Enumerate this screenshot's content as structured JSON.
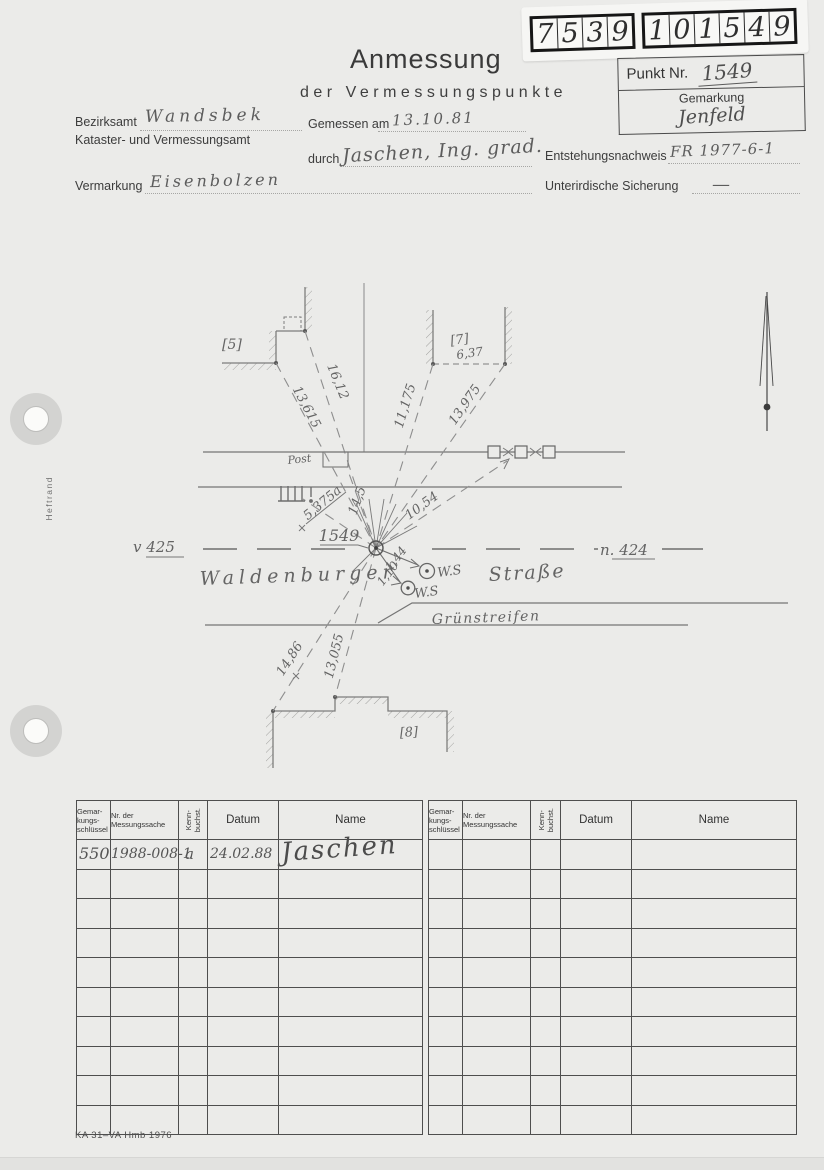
{
  "sticker": {
    "g1": [
      "7",
      "5",
      "3",
      "9"
    ],
    "g2": [
      "1",
      "0",
      "1",
      "5",
      "4",
      "9"
    ]
  },
  "punkt_box": {
    "punkt_label": "Punkt Nr.",
    "punkt_value": "1549",
    "gemarkung_label": "Gemarkung",
    "gemarkung_value": "Jenfeld"
  },
  "header": {
    "title": "Anmessung",
    "subtitle": "der Vermessungspunkte",
    "bezirksamt_label": "Bezirksamt",
    "bezirksamt_value": "Wandsbek",
    "amt_label": "Kataster- und Vermessungsamt",
    "gemessen_label": "Gemessen am",
    "gemessen_value": "13.10.81",
    "durch_label": "durch",
    "durch_value": "Jaschen, Ing. grad.",
    "vermarkung_label": "Vermarkung",
    "vermarkung_value": "Eisenbolzen",
    "entstehung_label": "Entstehungsnachweis",
    "entstehung_value": "FR 1977-6-1",
    "sicherung_label": "Unterirdische Sicherung",
    "sicherung_value": "—"
  },
  "margin": {
    "heftrand": "Heftrand"
  },
  "sketch": {
    "b5": "[5]",
    "b7": "[7]",
    "b7_height": "6,37",
    "b8": "[8]",
    "m1612": "16,12",
    "m13615": "13,615",
    "m11175": "11,175",
    "m13975": "13,975",
    "m1054": "10,54",
    "m145": "14,5",
    "m5375a": "5,375a",
    "point": "1549",
    "m144": "1,44",
    "m110": "1,10",
    "ws1": "W.S",
    "ws2": "W.S",
    "v425": "v 425",
    "n424": "n. 424",
    "street1": "Waldenburger",
    "street2": "Straße",
    "gruenstreifen": "Grünstreifen",
    "post": "Post",
    "m1486": "14,86",
    "m13055": "13,055"
  },
  "table": {
    "headers": {
      "col1": "Gemar-\nkungs-\nschlüssel",
      "col2": "Nr. der\nMessungssache",
      "col3": "Kenn-\nbuchst.",
      "col4": "Datum",
      "col5": "Name"
    },
    "row1": {
      "schluessel": "550",
      "messungssache": "1988-008-1",
      "kenn": "a",
      "datum": "24.02.88",
      "name": "Jaschen"
    }
  },
  "footer": {
    "form_code": "KA 31–VA Hmb 1976"
  }
}
